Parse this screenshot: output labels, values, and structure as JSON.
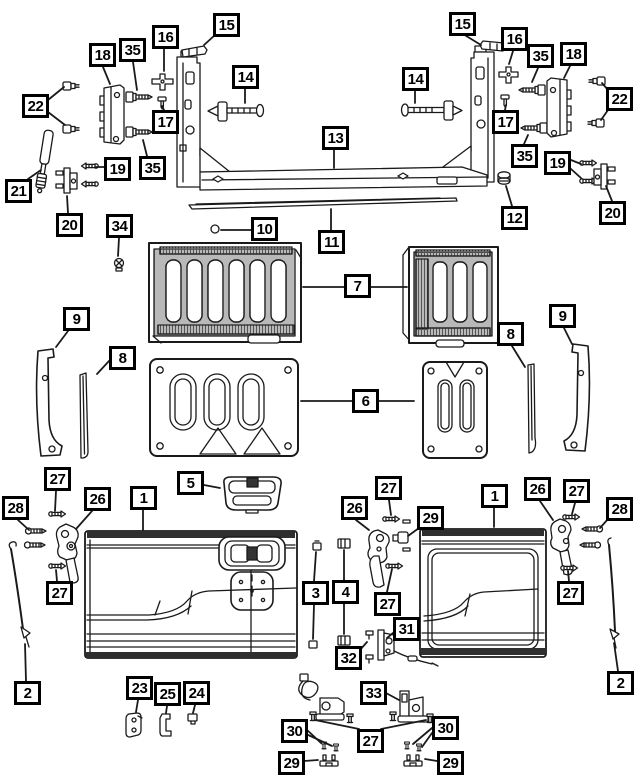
{
  "diagram": {
    "kind": "exploded-parts-diagram",
    "subject": "tailgate-assembly",
    "background": "#ffffff",
    "line_color": "#1a1a1a",
    "callout_border": "#000000",
    "callout_fill": "#ffffff",
    "callout_text": "#000000"
  },
  "callouts": [
    {
      "id": "15-left",
      "label": "15",
      "x": 213,
      "y": 13,
      "leaders": [
        [
          215,
          35,
          204,
          45
        ]
      ]
    },
    {
      "id": "16-left",
      "label": "16",
      "x": 152,
      "y": 25,
      "leaders": [
        [
          164,
          49,
          164,
          71
        ]
      ]
    },
    {
      "id": "35-left-top",
      "label": "35",
      "x": 119,
      "y": 38,
      "leaders": [
        [
          133,
          62,
          137,
          90
        ]
      ]
    },
    {
      "id": "18-left",
      "label": "18",
      "x": 89,
      "y": 43,
      "leaders": [
        [
          103,
          67,
          110,
          84
        ]
      ]
    },
    {
      "id": "22-left",
      "label": "22",
      "x": 22,
      "y": 94,
      "leaders": [
        [
          48,
          100,
          64,
          87
        ],
        [
          48,
          112,
          65,
          125
        ]
      ]
    },
    {
      "id": "14-left",
      "label": "14",
      "x": 232,
      "y": 65,
      "leaders": [
        [
          245,
          89,
          245,
          103
        ]
      ]
    },
    {
      "id": "17-left",
      "label": "17",
      "x": 152,
      "y": 110,
      "leaders": [
        [
          164,
          110,
          162,
          106
        ]
      ]
    },
    {
      "id": "19-left",
      "label": "19",
      "x": 104,
      "y": 157,
      "leaders": [
        [
          104,
          167,
          96,
          167
        ]
      ]
    },
    {
      "id": "35-left-bottom",
      "label": "35",
      "x": 139,
      "y": 156,
      "leaders": [
        [
          147,
          156,
          143,
          140
        ]
      ]
    },
    {
      "id": "21",
      "label": "21",
      "x": 5,
      "y": 179,
      "leaders": [
        [
          28,
          179,
          41,
          170
        ]
      ]
    },
    {
      "id": "20-left",
      "label": "20",
      "x": 56,
      "y": 213,
      "leaders": [
        [
          68,
          213,
          67,
          196
        ]
      ]
    },
    {
      "id": "34",
      "label": "34",
      "x": 106,
      "y": 214,
      "leaders": [
        [
          119,
          238,
          118,
          256
        ]
      ]
    },
    {
      "id": "10",
      "label": "10",
      "x": 251,
      "y": 217,
      "leaders": [
        [
          251,
          230,
          221,
          230
        ]
      ]
    },
    {
      "id": "13",
      "label": "13",
      "x": 322,
      "y": 126,
      "leaders": [
        [
          334,
          150,
          334,
          168
        ]
      ]
    },
    {
      "id": "11",
      "label": "11",
      "x": 318,
      "y": 230,
      "leaders": [
        [
          331,
          230,
          331,
          209
        ]
      ]
    },
    {
      "id": "15-right",
      "label": "15",
      "x": 449,
      "y": 12,
      "leaders": [
        [
          463,
          34,
          481,
          45
        ]
      ]
    },
    {
      "id": "16-right",
      "label": "16",
      "x": 501,
      "y": 27,
      "leaders": [
        [
          513,
          51,
          509,
          64
        ]
      ]
    },
    {
      "id": "35-right-top",
      "label": "35",
      "x": 527,
      "y": 44,
      "leaders": [
        [
          538,
          68,
          532,
          82
        ]
      ]
    },
    {
      "id": "18-right",
      "label": "18",
      "x": 560,
      "y": 42,
      "leaders": [
        [
          570,
          66,
          564,
          78
        ]
      ]
    },
    {
      "id": "22-right",
      "label": "22",
      "x": 606,
      "y": 87,
      "leaders": [
        [
          608,
          90,
          602,
          83
        ],
        [
          608,
          110,
          601,
          120
        ]
      ]
    },
    {
      "id": "14-right",
      "label": "14",
      "x": 402,
      "y": 67,
      "leaders": [
        [
          415,
          91,
          415,
          103
        ]
      ]
    },
    {
      "id": "17-right",
      "label": "17",
      "x": 492,
      "y": 110,
      "leaders": [
        [
          505,
          110,
          506,
          105
        ]
      ]
    },
    {
      "id": "35-right-bottom",
      "label": "35",
      "x": 511,
      "y": 144,
      "leaders": [
        [
          524,
          144,
          528,
          135
        ]
      ]
    },
    {
      "id": "19-right",
      "label": "19",
      "x": 544,
      "y": 151,
      "leaders": [
        [
          571,
          160,
          581,
          164
        ],
        [
          571,
          169,
          581,
          178
        ]
      ]
    },
    {
      "id": "20-right",
      "label": "20",
      "x": 599,
      "y": 201,
      "leaders": [
        [
          612,
          201,
          606,
          186
        ]
      ]
    },
    {
      "id": "12",
      "label": "12",
      "x": 501,
      "y": 206,
      "leaders": [
        [
          512,
          206,
          506,
          186
        ]
      ]
    },
    {
      "id": "7",
      "label": "7",
      "x": 344,
      "y": 274,
      "leaders": [
        [
          344,
          287,
          303,
          287
        ],
        [
          371,
          287,
          407,
          287
        ]
      ]
    },
    {
      "id": "9-left",
      "label": "9",
      "x": 63,
      "y": 307,
      "leaders": [
        [
          68,
          331,
          56,
          347
        ]
      ]
    },
    {
      "id": "8-left",
      "label": "8",
      "x": 109,
      "y": 346,
      "leaders": [
        [
          109,
          361,
          97,
          374
        ]
      ]
    },
    {
      "id": "9-right",
      "label": "9",
      "x": 549,
      "y": 304,
      "leaders": [
        [
          564,
          328,
          572,
          344
        ]
      ]
    },
    {
      "id": "8-right",
      "label": "8",
      "x": 497,
      "y": 322,
      "leaders": [
        [
          512,
          346,
          525,
          367
        ]
      ]
    },
    {
      "id": "6",
      "label": "6",
      "x": 352,
      "y": 389,
      "leaders": [
        [
          352,
          401,
          301,
          401
        ],
        [
          379,
          401,
          414,
          401
        ]
      ]
    },
    {
      "id": "5",
      "label": "5",
      "x": 177,
      "y": 471,
      "leaders": [
        [
          204,
          485,
          220,
          488
        ]
      ]
    },
    {
      "id": "1-left",
      "label": "1",
      "x": 130,
      "y": 486,
      "leaders": [
        [
          143,
          510,
          143,
          530
        ]
      ]
    },
    {
      "id": "27-left-top",
      "label": "27",
      "x": 44,
      "y": 467,
      "leaders": [
        [
          56,
          491,
          55,
          511
        ]
      ]
    },
    {
      "id": "26-left",
      "label": "26",
      "x": 84,
      "y": 487,
      "leaders": [
        [
          92,
          511,
          76,
          529
        ]
      ]
    },
    {
      "id": "28-left",
      "label": "28",
      "x": 2,
      "y": 496,
      "leaders": [
        [
          18,
          520,
          29,
          530
        ]
      ]
    },
    {
      "id": "27-left-bottom",
      "label": "27",
      "x": 46,
      "y": 581,
      "leaders": [
        [
          57,
          581,
          56,
          570
        ]
      ]
    },
    {
      "id": "2-left",
      "label": "2",
      "x": 14,
      "y": 681,
      "leaders": [
        [
          26,
          681,
          25,
          644
        ]
      ]
    },
    {
      "id": "23",
      "label": "23",
      "x": 126,
      "y": 676,
      "leaders": [
        [
          138,
          700,
          136,
          712
        ]
      ]
    },
    {
      "id": "25",
      "label": "25",
      "x": 154,
      "y": 682,
      "leaders": [
        [
          167,
          706,
          166,
          713
        ]
      ]
    },
    {
      "id": "24",
      "label": "24",
      "x": 183,
      "y": 681,
      "leaders": [
        [
          195,
          705,
          193,
          713
        ]
      ]
    },
    {
      "id": "3",
      "label": "3",
      "x": 302,
      "y": 581,
      "leaders": [
        [
          314,
          581,
          316,
          552
        ],
        [
          314,
          605,
          313,
          639
        ]
      ]
    },
    {
      "id": "4",
      "label": "4",
      "x": 332,
      "y": 580,
      "leaders": [
        [
          344,
          580,
          344,
          550
        ],
        [
          344,
          604,
          344,
          634
        ]
      ]
    },
    {
      "id": "26-mid",
      "label": "26",
      "x": 341,
      "y": 496,
      "leaders": [
        [
          356,
          520,
          369,
          530
        ]
      ]
    },
    {
      "id": "27-mid-top",
      "label": "27",
      "x": 375,
      "y": 476,
      "leaders": [
        [
          389,
          500,
          391,
          515
        ]
      ]
    },
    {
      "id": "29-mid",
      "label": "29",
      "x": 417,
      "y": 506,
      "leaders": [
        [
          419,
          528,
          408,
          536
        ]
      ]
    },
    {
      "id": "1-right",
      "label": "1",
      "x": 481,
      "y": 484,
      "leaders": [
        [
          494,
          508,
          494,
          527
        ]
      ]
    },
    {
      "id": "26-right",
      "label": "26",
      "x": 524,
      "y": 477,
      "leaders": [
        [
          540,
          501,
          553,
          520
        ]
      ]
    },
    {
      "id": "27-right-top",
      "label": "27",
      "x": 563,
      "y": 479,
      "leaders": [
        [
          575,
          503,
          572,
          514
        ]
      ]
    },
    {
      "id": "28-right",
      "label": "28",
      "x": 606,
      "y": 497,
      "leaders": [
        [
          608,
          519,
          600,
          528
        ]
      ]
    },
    {
      "id": "27-right-bottom",
      "label": "27",
      "x": 557,
      "y": 581,
      "leaders": [
        [
          569,
          581,
          568,
          571
        ]
      ]
    },
    {
      "id": "2-right",
      "label": "2",
      "x": 607,
      "y": 671,
      "leaders": [
        [
          618,
          671,
          614,
          643
        ]
      ]
    },
    {
      "id": "27-mid-bottom",
      "label": "27",
      "x": 374,
      "y": 592,
      "leaders": [
        [
          387,
          592,
          392,
          569
        ]
      ]
    },
    {
      "id": "31",
      "label": "31",
      "x": 393,
      "y": 617,
      "leaders": [
        [
          393,
          633,
          387,
          638
        ]
      ]
    },
    {
      "id": "32",
      "label": "32",
      "x": 335,
      "y": 646,
      "leaders": [
        [
          360,
          650,
          367,
          642
        ]
      ]
    },
    {
      "id": "33",
      "label": "33",
      "x": 360,
      "y": 681,
      "leaders": [
        [
          386,
          693,
          399,
          700
        ]
      ]
    },
    {
      "id": "27-bottom",
      "label": "27",
      "x": 357,
      "y": 729,
      "leaders": [
        [
          359,
          729,
          315,
          720
        ],
        [
          381,
          729,
          426,
          720
        ]
      ]
    },
    {
      "id": "30-left",
      "label": "30",
      "x": 281,
      "y": 719,
      "leaders": [
        [
          306,
          729,
          321,
          743
        ],
        [
          306,
          734,
          332,
          746
        ]
      ]
    },
    {
      "id": "29-bottom-left",
      "label": "29",
      "x": 278,
      "y": 751,
      "leaders": [
        [
          304,
          761,
          318,
          760
        ]
      ]
    },
    {
      "id": "30-right",
      "label": "30",
      "x": 432,
      "y": 716,
      "leaders": [
        [
          432,
          728,
          413,
          744
        ],
        [
          432,
          733,
          422,
          747
        ]
      ]
    },
    {
      "id": "29-bottom-right",
      "label": "29",
      "x": 437,
      "y": 751,
      "leaders": [
        [
          437,
          761,
          425,
          759
        ]
      ]
    }
  ]
}
